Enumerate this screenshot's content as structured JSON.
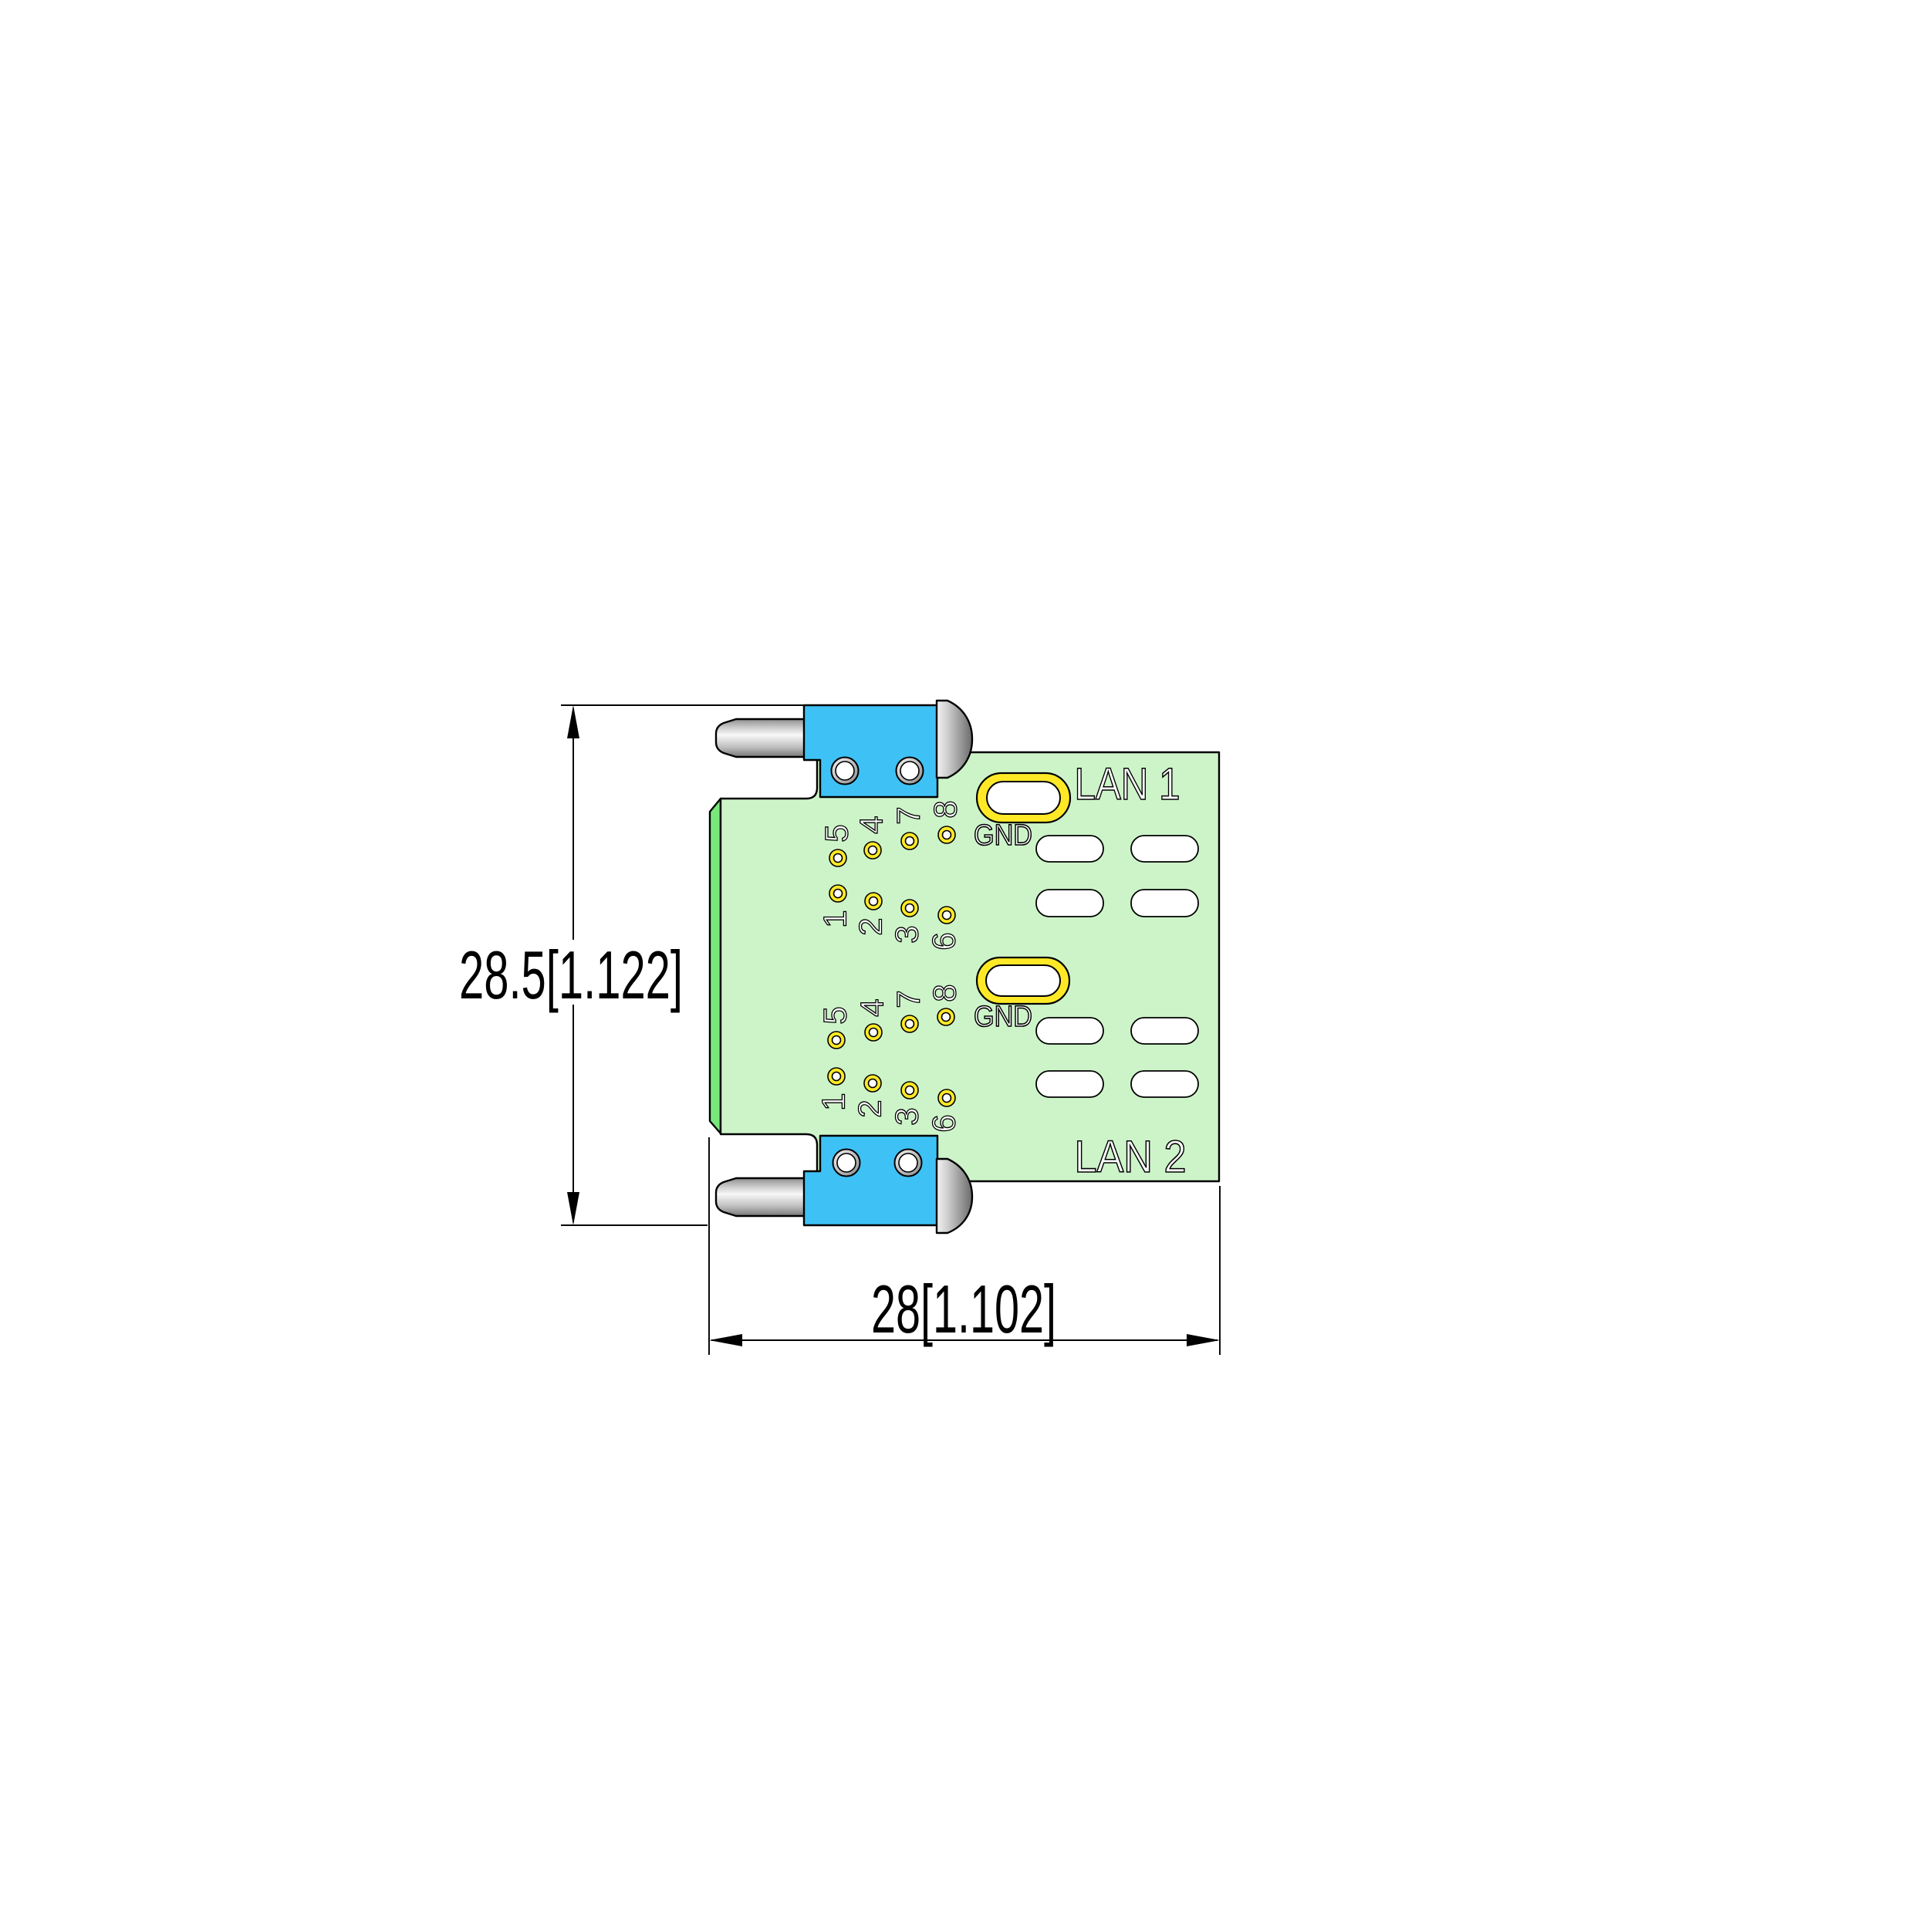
{
  "drawing": {
    "dimensions": {
      "height": "28.5[1.122]",
      "width": "28[1.102]"
    },
    "connectors": [
      {
        "label": "LAN 1",
        "gnd_label": "GND",
        "pins_top": [
          "5",
          "4",
          "7",
          "8"
        ],
        "pins_bottom": [
          "1",
          "2",
          "3",
          "6"
        ]
      },
      {
        "label": "LAN 2",
        "gnd_label": "GND",
        "pins_top": [
          "5",
          "4",
          "7",
          "8"
        ],
        "pins_bottom": [
          "1",
          "2",
          "3",
          "6"
        ]
      }
    ],
    "colors": {
      "board_green": "#cdf4c9",
      "board_edge_green": "#79e87b",
      "connector_blue": "#3ec2f6",
      "pad_yellow": "#ffe927",
      "line_black": "#000000",
      "background": "#ffffff"
    }
  }
}
